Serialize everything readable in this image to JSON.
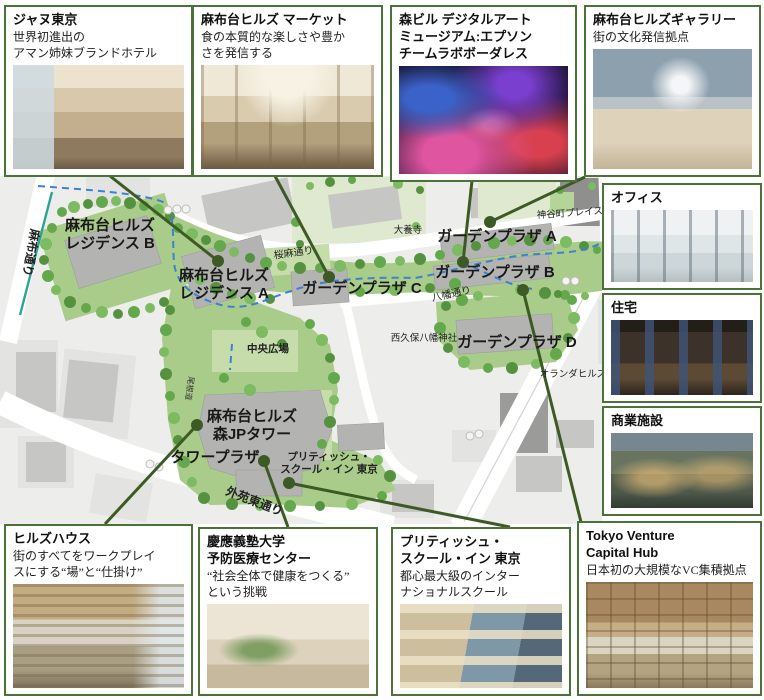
{
  "colors": {
    "box_border_green": "#4b7239",
    "leader_green": "#3d5a24",
    "route_dashed_blue": "#3b82d0",
    "subway_teal": "#2aa593",
    "site_green": "#a9cc8a",
    "tree_green": "#64a84c"
  },
  "callouts": {
    "top": [
      {
        "id": "janu",
        "title": "ジャヌ東京",
        "desc": "世界初進出の\nアマン姉妹ブランドホテル"
      },
      {
        "id": "market",
        "title": "麻布台ヒルズ マーケット",
        "desc": "食の本質的な楽しさや豊か\nさを発信する"
      },
      {
        "id": "teamlab",
        "title": "森ビル デジタルアート\nミュージアム:エプソン\nチームラボボーダレス",
        "desc": ""
      },
      {
        "id": "gallery",
        "title": "麻布台ヒルズギャラリー",
        "desc": "街の文化発信拠点"
      }
    ],
    "right": [
      {
        "id": "office",
        "label": "オフィス"
      },
      {
        "id": "residence",
        "label": "住宅"
      },
      {
        "id": "commercial",
        "label": "商業施設"
      }
    ],
    "bottom": [
      {
        "id": "hillshouse",
        "title": "ヒルズハウス",
        "desc": "街のすべてをワークプレイ\nスにする“場”と“仕掛け”"
      },
      {
        "id": "keio",
        "title": "慶應義塾大学\n予防医療センター",
        "desc": "“社会全体で健康をつくる”\nという挑戦"
      },
      {
        "id": "school",
        "title": "プリティッシュ・\nスクール・イン 東京",
        "desc": "都心最大級のインター\nナショナルスクール"
      },
      {
        "id": "vch",
        "title": "Tokyo Venture\nCapital Hub",
        "desc": "日本初の大規模なVC集積拠点"
      }
    ]
  },
  "map": {
    "labels": [
      {
        "name": "label-residence-b",
        "text": "麻布台ヒルズ\nレジデンス B",
        "x": 110,
        "y": 230,
        "size": 15,
        "rot": 0,
        "bold": true,
        "color": "#191919"
      },
      {
        "name": "label-residence-a",
        "text": "麻布台ヒルズ\nレジデンス A",
        "x": 224,
        "y": 280,
        "size": 15,
        "rot": 0,
        "bold": true,
        "color": "#191919"
      },
      {
        "name": "label-garden-plaza-a",
        "text": "ガーデンプラザ A",
        "x": 497,
        "y": 241,
        "size": 15,
        "rot": 0,
        "bold": true,
        "color": "#191919"
      },
      {
        "name": "label-garden-plaza-b",
        "text": "ガーデンプラザ B",
        "x": 495,
        "y": 277,
        "size": 15,
        "rot": 0,
        "bold": true,
        "color": "#191919"
      },
      {
        "name": "label-garden-plaza-c",
        "text": "ガーデンプラザ C",
        "x": 362,
        "y": 293,
        "size": 15,
        "rot": 0,
        "bold": true,
        "color": "#191919"
      },
      {
        "name": "label-garden-plaza-d",
        "text": "ガーデンプラザ D",
        "x": 517,
        "y": 347,
        "size": 15,
        "rot": 0,
        "bold": true,
        "color": "#191919"
      },
      {
        "name": "label-mori-jp-tower",
        "text": "麻布台ヒルズ\n森JPタワー",
        "x": 252,
        "y": 421,
        "size": 15,
        "rot": 0,
        "bold": true,
        "color": "#191919"
      },
      {
        "name": "label-tower-plaza",
        "text": "タワープラザ",
        "x": 215,
        "y": 462,
        "size": 15,
        "rot": 0,
        "bold": true,
        "color": "#191919"
      },
      {
        "name": "label-british-school-map",
        "text": "プリティッシュ・\nスクール・イン 東京",
        "x": 329,
        "y": 460,
        "size": 10.5,
        "rot": 0,
        "bold": true,
        "color": "#222"
      },
      {
        "name": "label-central-square",
        "text": "中央広場",
        "x": 268,
        "y": 352,
        "size": 10.5,
        "rot": 0,
        "bold": true,
        "color": "#222"
      },
      {
        "name": "label-azabu-dori",
        "text": "麻布通り",
        "x": 27,
        "y": 252,
        "size": 12,
        "rot": 100,
        "bold": true,
        "color": "#222"
      },
      {
        "name": "label-sakura-asa-dori",
        "text": "桜麻通り",
        "x": 294,
        "y": 256,
        "size": 10,
        "rot": -8,
        "bold": false,
        "color": "#222"
      },
      {
        "name": "label-hachiman-dori",
        "text": "八幡通り",
        "x": 452,
        "y": 297,
        "size": 10,
        "rot": -12,
        "bold": false,
        "color": "#222"
      },
      {
        "name": "label-gaien-higashi-dori",
        "text": "外苑東通り",
        "x": 253,
        "y": 505,
        "size": 12,
        "rot": 21,
        "bold": true,
        "color": "#222"
      },
      {
        "name": "label-onemichi",
        "text": "尾根道",
        "x": 187,
        "y": 388,
        "size": 8,
        "rot": 98,
        "bold": false,
        "color": "#333"
      },
      {
        "name": "label-kamiyacho-place",
        "text": "神谷町プレイス",
        "x": 570,
        "y": 216,
        "size": 9.5,
        "rot": -4,
        "bold": false,
        "color": "#222"
      },
      {
        "name": "label-taiyoji",
        "text": "大養寺",
        "x": 408,
        "y": 233,
        "size": 9.5,
        "rot": 0,
        "bold": false,
        "color": "#222"
      },
      {
        "name": "label-nishikubo-hachiman-shrine",
        "text": "西久保八幡神社",
        "x": 424,
        "y": 341,
        "size": 9.5,
        "rot": 0,
        "bold": false,
        "color": "#222"
      },
      {
        "name": "label-oranda-hills",
        "text": "オランダヒルズ",
        "x": 573,
        "y": 377,
        "size": 9.5,
        "rot": 0,
        "bold": false,
        "color": "#222"
      }
    ],
    "leaders": [
      {
        "name": "leader-janu",
        "x1": 110,
        "y1": 176,
        "x2": 218,
        "y2": 261
      },
      {
        "name": "leader-market",
        "x1": 275,
        "y1": 176,
        "x2": 329,
        "y2": 277
      },
      {
        "name": "leader-teamlab",
        "x1": 472,
        "y1": 181,
        "x2": 463,
        "y2": 262
      },
      {
        "name": "leader-gallery",
        "x1": 585,
        "y1": 177,
        "x2": 490,
        "y2": 222
      },
      {
        "name": "leader-hillshouse",
        "x1": 105,
        "y1": 524,
        "x2": 197,
        "y2": 425
      },
      {
        "name": "leader-keio",
        "x1": 288,
        "y1": 527,
        "x2": 264,
        "y2": 461
      },
      {
        "name": "leader-school",
        "x1": 510,
        "y1": 527,
        "x2": 289,
        "y2": 483
      },
      {
        "name": "leader-vch",
        "x1": 581,
        "y1": 522,
        "x2": 523,
        "y2": 290
      }
    ]
  }
}
